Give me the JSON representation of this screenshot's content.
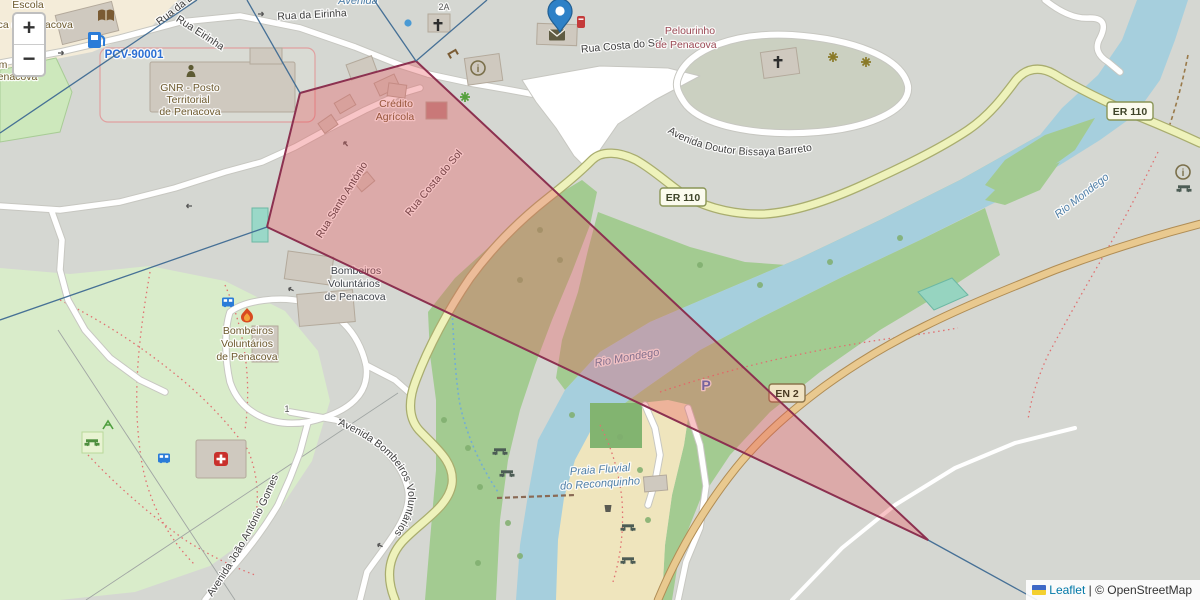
{
  "ui": {
    "zoom_in": "+",
    "zoom_out": "−",
    "attribution": {
      "leaflet": "Leaflet",
      "separator": "|",
      "copyright": "© OpenStreetMap"
    }
  },
  "colors": {
    "land": "#d5d7d2",
    "cream": "#f4ecd9",
    "park": "#d9ecca",
    "woodland": "#a3cb91",
    "water": "#a6cfdd",
    "sand": "#efe5bd",
    "road_yellow": "#eef2bb",
    "road_orange": "#e9c98f",
    "overlay_fill": "rgba(233,80,85,0.33)",
    "overlay_stroke": "#8c3150",
    "ray": "#3f6b93",
    "marker_blue": "#2E81C7",
    "link_blue": "#0078A8"
  },
  "icons": {
    "pin": "map-marker-icon",
    "fuel": "fuel-station-icon",
    "book": "library-icon",
    "police": "police-icon",
    "church": "christian-cross-icon",
    "info": "information-icon",
    "bus": "bus-stop-icon",
    "hospital": "hospital-icon",
    "fire": "fire-station-icon",
    "picnic": "picnic-table-icon",
    "viewpoint": "viewpoint-icon",
    "post": "post-office-icon",
    "postbox": "post-box-icon",
    "waste": "waste-basket-icon",
    "playground": "playground-icon",
    "fountain": "fountain-icon",
    "bench": "bench-icon",
    "flag": "ukraine-flag-icon"
  },
  "labels": {
    "escola_line1": "Escola",
    "escola_line2": "Básica de Penacova",
    "frag_m": "m",
    "frag_penacova": "Penacova",
    "pcv": "PCV-90001",
    "rua_da_ei": "Rua da Ei",
    "rua_eirinha": "Rua Eirinha",
    "rua_da_eirinha": "Rua da Eirinha",
    "avenida_frag": "Avenida",
    "gnr_line1": "GNR - Posto",
    "gnr_line2": "Territorial",
    "gnr_line3": "de Penacova",
    "rua_costa_do_sol": "Rua Costa do Sol",
    "pelourinho_line1": "Pelourinho",
    "pelourinho_line2": "de Penacova",
    "bissaya": "Avenida Doutor Bissaya Barreto",
    "credito_line1": "Crédito",
    "credito_line2": "Agrícola",
    "rua_santo_antonio": "Rua Santo António",
    "er110": "ER 110",
    "en2": "EN 2",
    "rio_mondego": "Rio Mondego",
    "bombeiros_line1": "Bombeiros",
    "bombeiros_line2": "Voluntários",
    "bombeiros_line3": "de Penacova",
    "av_bombeiros": "Avenida Bombeiros Voluntários",
    "av_joao": "Avenida João António Gomes",
    "praia_line1": "Praia Fluvial",
    "praia_line2": "do Reconquinho",
    "parking": "P",
    "house_1": "1",
    "house_2a": "2A"
  }
}
